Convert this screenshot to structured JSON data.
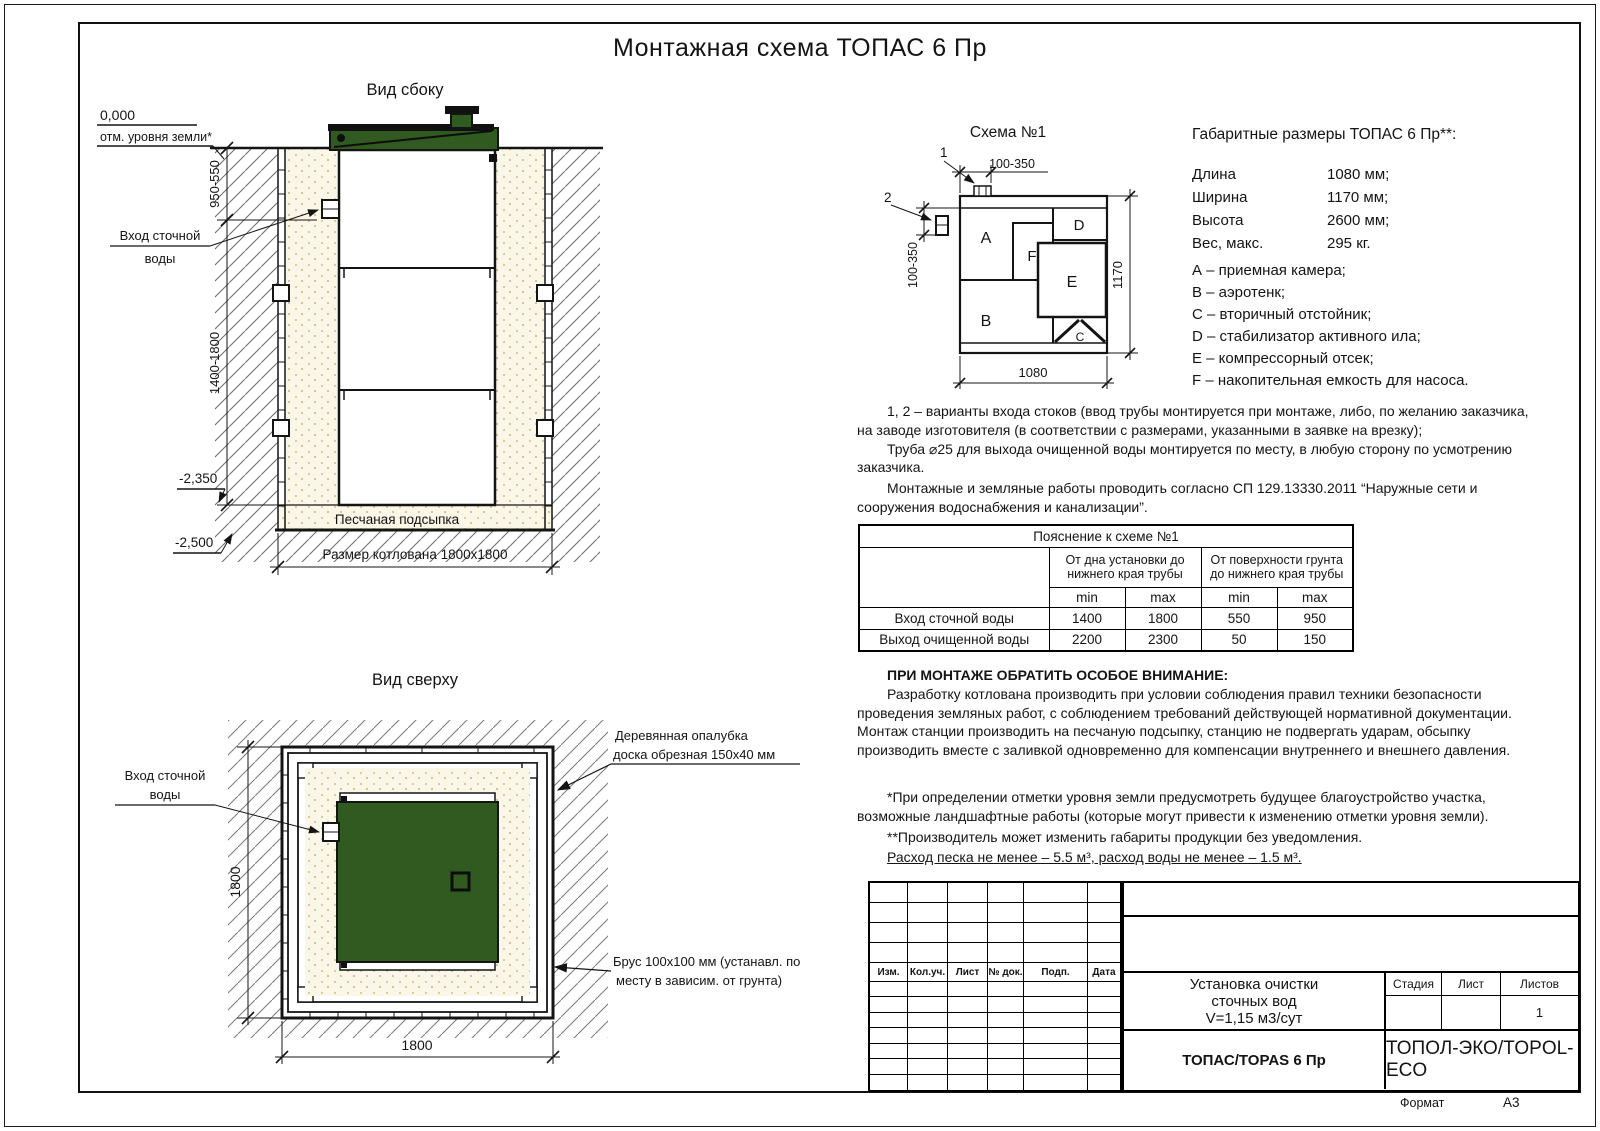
{
  "sheet": {
    "title": "Монтажная схема ТОПАС 6 Пр",
    "format_label": "Формат",
    "format_value": "А3"
  },
  "side_view": {
    "title": "Вид сбоку",
    "level_zero": "0,000",
    "level_zero_label": "отм. уровня земли*",
    "dim_upper": "950-550",
    "dim_lower": "1400-1800",
    "level_minus2350": "-2,350",
    "level_minus2500": "-2,500",
    "inlet_line1": "Вход сточной",
    "inlet_line2": "воды",
    "sand_label": "Песчаная подсыпка",
    "pit_dim": "Размер котлована 1800х1800"
  },
  "top_view": {
    "title": "Вид сверху",
    "dim_vertical": "1800",
    "dim_horizontal": "1800",
    "inlet_line1": "Вход сточной",
    "inlet_line2": "воды",
    "formwork_line1": "Деревянная опалубка",
    "formwork_line2": "доска обрезная 150х40 мм",
    "beam_line1": "Брус 100х100 мм (устанавл. по",
    "beam_line2": "месту в зависим. от грунта)"
  },
  "schema": {
    "title": "Схема №1",
    "callout1": "1",
    "callout2": "2",
    "dim_top": "100-350",
    "dim_left": "100-350",
    "dim_right": "1170",
    "dim_bottom": "1080",
    "comp_a": "A",
    "comp_b": "B",
    "comp_c": "C",
    "comp_d": "D",
    "comp_e": "E",
    "comp_f": "F"
  },
  "specs": {
    "title": "Габаритные размеры ТОПАС 6 Пр**:",
    "rows": [
      {
        "label": "Длина",
        "value": "1080 мм;"
      },
      {
        "label": "Ширина",
        "value": "1170 мм;"
      },
      {
        "label": "Высота",
        "value": "2600 мм;"
      },
      {
        "label": "Вес, макс.",
        "value": "295 кг."
      }
    ],
    "legend": [
      "А – приемная камера;",
      "В – аэротенк;",
      "С – вторичный отстойник;",
      "D – стабилизатор активного ила;",
      "Е – компрессорный отсек;",
      "F – накопительная емкость для насоса."
    ]
  },
  "notes": {
    "p1a": "1, 2 – варианты входа  стоков (ввод трубы монтируется при монтаже, либо, по желанию заказчика, на заводе изготовителя (в соответствии с размерами, указанными в заявке на врезку);",
    "p1b": "Труба ⌀25 для выхода очищенной воды монтируется по месту, в любую сторону по усмотрению заказчика.",
    "p2": "Монтажные и земляные работы проводить согласно СП 129.13330.2011 “Наружные сети и сооружения водоснабжения и канализации”.",
    "attention_title": "ПРИ МОНТАЖЕ ОБРАТИТЬ ОСОБОЕ ВНИМАНИЕ:",
    "attention_body": "Разработку котлована производить при условии соблюдения правил техники безопасности проведения земляных работ, с соблюдением требований действующей нормативной документации. Монтаж станции производить на песчаную подсыпку, станцию не подвергать ударам, обсыпку производить вместе с заливкой одновременно для компенсации внутреннего и внешнего давления.",
    "footnote1": "*При определении отметки уровня земли предусмотреть будущее благоустройство участка, возможные ландшафтные работы (которые могут привести к изменению отметки уровня земли).",
    "footnote2": "**Производитель может изменить габариты продукции без уведомления.",
    "consumption": "Расход песка не менее – 5.5 м³, расход воды не менее – 1.5 м³."
  },
  "table": {
    "title": "Пояснение к схеме №1",
    "group1": "От дна установки до нижнего края трубы",
    "group2": "От поверхности грунта до нижнего края трубы",
    "min1": "min",
    "max1": "max",
    "min2": "min",
    "max2": "max",
    "rows": [
      {
        "label": "Вход сточной воды",
        "v1": "1400",
        "v2": "1800",
        "v3": "550",
        "v4": "950"
      },
      {
        "label": "Выход очищенной воды",
        "v1": "2200",
        "v2": "2300",
        "v3": "50",
        "v4": "150"
      }
    ]
  },
  "title_block": {
    "rev_headers": [
      "Изм.",
      "Кол.уч.",
      "Лист",
      "№ док.",
      "Подп.",
      "Дата"
    ],
    "doc_title_1": "Установка очистки",
    "doc_title_2": "сточных вод",
    "doc_title_3": "V=1,15 м3/сут",
    "stage_label": "Стадия",
    "sheet_label": "Лист",
    "sheets_label": "Листов",
    "sheets_value": "1",
    "model": "ТОПАС/TOPAS 6 Пр",
    "company": "ТОПОЛ-ЭКО/TOPOL-ECO"
  },
  "colors": {
    "lid_green": "#305a20",
    "sand": "#fbf7e8",
    "line": "#141414"
  }
}
